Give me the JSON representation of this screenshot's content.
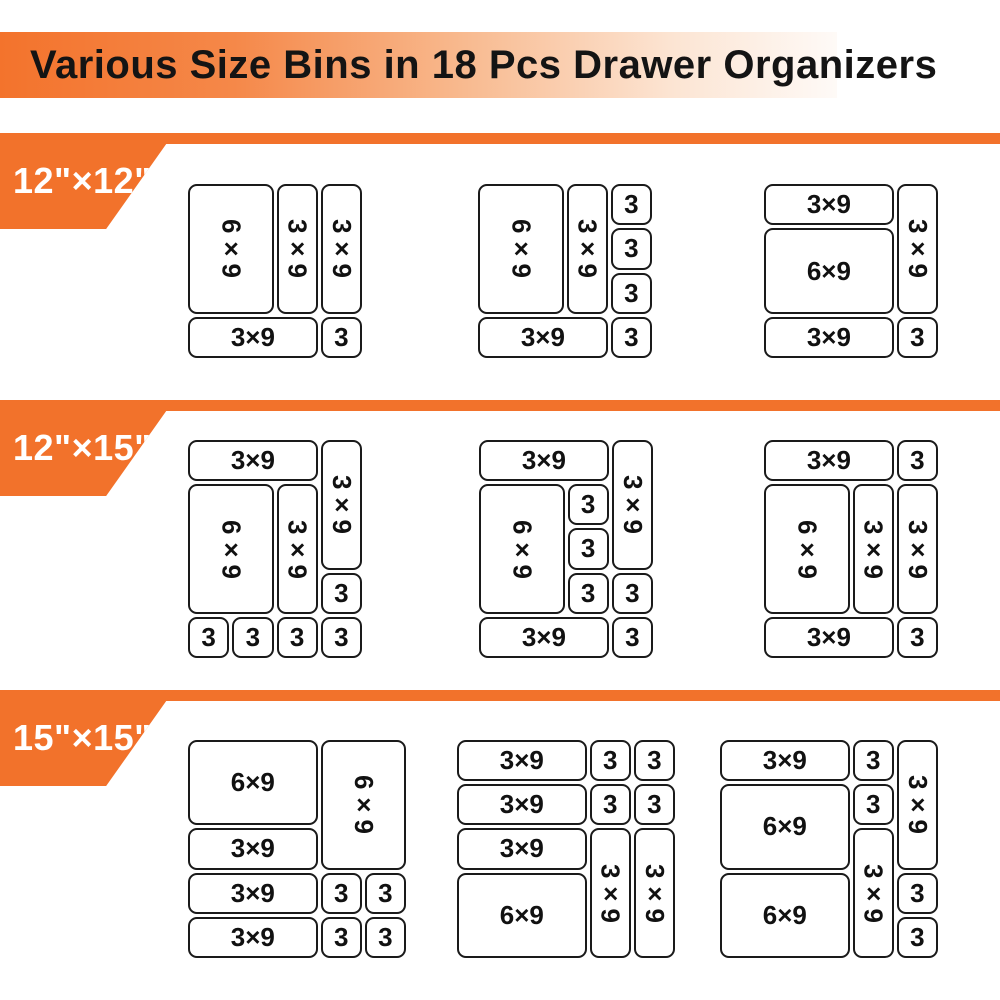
{
  "title": "Various Size Bins in 18 Pcs Drawer Organizers",
  "colors": {
    "accent_orange": "#f2722b",
    "banner_gradient_start": "#f3732c",
    "banner_gradient_end": "#fefaf7",
    "band_label_text": "#ffffff",
    "title_text": "#141414",
    "bin_border": "#1a1a1a",
    "bin_fill": "#ffffff"
  },
  "sections": [
    {
      "label": "12\"×12\"",
      "organizers": [
        {
          "cols": 4,
          "rows": 4,
          "bins": [
            {
              "label": "6×9",
              "c": 1,
              "r": 1,
              "cs": 2,
              "rs": 3,
              "vertical": true
            },
            {
              "label": "3×9",
              "c": 3,
              "r": 1,
              "cs": 1,
              "rs": 3,
              "vertical": true
            },
            {
              "label": "3×9",
              "c": 4,
              "r": 1,
              "cs": 1,
              "rs": 3,
              "vertical": true
            },
            {
              "label": "3×9",
              "c": 1,
              "r": 4,
              "cs": 3,
              "rs": 1
            },
            {
              "label": "3",
              "c": 4,
              "r": 4,
              "cs": 1,
              "rs": 1
            }
          ]
        },
        {
          "cols": 4,
          "rows": 4,
          "bins": [
            {
              "label": "6×9",
              "c": 1,
              "r": 1,
              "cs": 2,
              "rs": 3,
              "vertical": true
            },
            {
              "label": "3×9",
              "c": 3,
              "r": 1,
              "cs": 1,
              "rs": 3,
              "vertical": true
            },
            {
              "label": "3",
              "c": 4,
              "r": 1,
              "cs": 1,
              "rs": 1
            },
            {
              "label": "3",
              "c": 4,
              "r": 2,
              "cs": 1,
              "rs": 1
            },
            {
              "label": "3",
              "c": 4,
              "r": 3,
              "cs": 1,
              "rs": 1
            },
            {
              "label": "3×9",
              "c": 1,
              "r": 4,
              "cs": 3,
              "rs": 1
            },
            {
              "label": "3",
              "c": 4,
              "r": 4,
              "cs": 1,
              "rs": 1
            }
          ]
        },
        {
          "cols": 4,
          "rows": 4,
          "bins": [
            {
              "label": "3×9",
              "c": 1,
              "r": 1,
              "cs": 3,
              "rs": 1
            },
            {
              "label": "3×9",
              "c": 4,
              "r": 1,
              "cs": 1,
              "rs": 3,
              "vertical": true
            },
            {
              "label": "6×9",
              "c": 1,
              "r": 2,
              "cs": 3,
              "rs": 2
            },
            {
              "label": "3×9",
              "c": 1,
              "r": 4,
              "cs": 3,
              "rs": 1
            },
            {
              "label": "3",
              "c": 4,
              "r": 4,
              "cs": 1,
              "rs": 1
            }
          ]
        }
      ]
    },
    {
      "label": "12\"×15\"",
      "organizers": [
        {
          "cols": 4,
          "rows": 5,
          "bins": [
            {
              "label": "3×9",
              "c": 1,
              "r": 1,
              "cs": 3,
              "rs": 1
            },
            {
              "label": "3×9",
              "c": 4,
              "r": 1,
              "cs": 1,
              "rs": 3,
              "vertical": true
            },
            {
              "label": "6×9",
              "c": 1,
              "r": 2,
              "cs": 2,
              "rs": 3,
              "vertical": true
            },
            {
              "label": "3×9",
              "c": 3,
              "r": 2,
              "cs": 1,
              "rs": 3,
              "vertical": true
            },
            {
              "label": "3",
              "c": 4,
              "r": 4,
              "cs": 1,
              "rs": 1
            },
            {
              "label": "3",
              "c": 1,
              "r": 5,
              "cs": 1,
              "rs": 1
            },
            {
              "label": "3",
              "c": 2,
              "r": 5,
              "cs": 1,
              "rs": 1
            },
            {
              "label": "3",
              "c": 3,
              "r": 5,
              "cs": 1,
              "rs": 1
            },
            {
              "label": "3",
              "c": 4,
              "r": 5,
              "cs": 1,
              "rs": 1
            }
          ]
        },
        {
          "cols": 4,
          "rows": 5,
          "bins": [
            {
              "label": "3×9",
              "c": 1,
              "r": 1,
              "cs": 3,
              "rs": 1
            },
            {
              "label": "3×9",
              "c": 4,
              "r": 1,
              "cs": 1,
              "rs": 3,
              "vertical": true
            },
            {
              "label": "6×9",
              "c": 1,
              "r": 2,
              "cs": 2,
              "rs": 3,
              "vertical": true
            },
            {
              "label": "3",
              "c": 3,
              "r": 2,
              "cs": 1,
              "rs": 1
            },
            {
              "label": "3",
              "c": 3,
              "r": 3,
              "cs": 1,
              "rs": 1
            },
            {
              "label": "3",
              "c": 3,
              "r": 4,
              "cs": 1,
              "rs": 1
            },
            {
              "label": "3",
              "c": 4,
              "r": 4,
              "cs": 1,
              "rs": 1
            },
            {
              "label": "3×9",
              "c": 1,
              "r": 5,
              "cs": 3,
              "rs": 1
            },
            {
              "label": "3",
              "c": 4,
              "r": 5,
              "cs": 1,
              "rs": 1
            }
          ]
        },
        {
          "cols": 4,
          "rows": 5,
          "bins": [
            {
              "label": "3×9",
              "c": 1,
              "r": 1,
              "cs": 3,
              "rs": 1
            },
            {
              "label": "3",
              "c": 4,
              "r": 1,
              "cs": 1,
              "rs": 1
            },
            {
              "label": "6×9",
              "c": 1,
              "r": 2,
              "cs": 2,
              "rs": 3,
              "vertical": true
            },
            {
              "label": "3×9",
              "c": 3,
              "r": 2,
              "cs": 1,
              "rs": 3,
              "vertical": true
            },
            {
              "label": "3×9",
              "c": 4,
              "r": 2,
              "cs": 1,
              "rs": 3,
              "vertical": true
            },
            {
              "label": "3×9",
              "c": 1,
              "r": 5,
              "cs": 3,
              "rs": 1
            },
            {
              "label": "3",
              "c": 4,
              "r": 5,
              "cs": 1,
              "rs": 1
            }
          ]
        }
      ]
    },
    {
      "label": "15\"×15\"",
      "organizers": [
        {
          "cols": 5,
          "rows": 5,
          "bins": [
            {
              "label": "6×9",
              "c": 1,
              "r": 1,
              "cs": 3,
              "rs": 2
            },
            {
              "label": "6×9",
              "c": 4,
              "r": 1,
              "cs": 2,
              "rs": 3,
              "vertical": true
            },
            {
              "label": "3×9",
              "c": 1,
              "r": 3,
              "cs": 3,
              "rs": 1
            },
            {
              "label": "3×9",
              "c": 1,
              "r": 4,
              "cs": 3,
              "rs": 1
            },
            {
              "label": "3",
              "c": 4,
              "r": 4,
              "cs": 1,
              "rs": 1
            },
            {
              "label": "3",
              "c": 5,
              "r": 4,
              "cs": 1,
              "rs": 1
            },
            {
              "label": "3×9",
              "c": 1,
              "r": 5,
              "cs": 3,
              "rs": 1
            },
            {
              "label": "3",
              "c": 4,
              "r": 5,
              "cs": 1,
              "rs": 1
            },
            {
              "label": "3",
              "c": 5,
              "r": 5,
              "cs": 1,
              "rs": 1
            }
          ]
        },
        {
          "cols": 5,
          "rows": 5,
          "bins": [
            {
              "label": "3×9",
              "c": 1,
              "r": 1,
              "cs": 3,
              "rs": 1
            },
            {
              "label": "3",
              "c": 4,
              "r": 1,
              "cs": 1,
              "rs": 1
            },
            {
              "label": "3",
              "c": 5,
              "r": 1,
              "cs": 1,
              "rs": 1
            },
            {
              "label": "3×9",
              "c": 1,
              "r": 2,
              "cs": 3,
              "rs": 1
            },
            {
              "label": "3",
              "c": 4,
              "r": 2,
              "cs": 1,
              "rs": 1
            },
            {
              "label": "3",
              "c": 5,
              "r": 2,
              "cs": 1,
              "rs": 1
            },
            {
              "label": "3×9",
              "c": 1,
              "r": 3,
              "cs": 3,
              "rs": 1
            },
            {
              "label": "6×9",
              "c": 1,
              "r": 4,
              "cs": 3,
              "rs": 2
            },
            {
              "label": "3×9",
              "c": 4,
              "r": 3,
              "cs": 1,
              "rs": 3,
              "vertical": true
            },
            {
              "label": "3×9",
              "c": 5,
              "r": 3,
              "cs": 1,
              "rs": 3,
              "vertical": true
            }
          ]
        },
        {
          "cols": 5,
          "rows": 5,
          "bins": [
            {
              "label": "3×9",
              "c": 1,
              "r": 1,
              "cs": 3,
              "rs": 1
            },
            {
              "label": "3",
              "c": 4,
              "r": 1,
              "cs": 1,
              "rs": 1
            },
            {
              "label": "3×9",
              "c": 5,
              "r": 1,
              "cs": 1,
              "rs": 3,
              "vertical": true
            },
            {
              "label": "6×9",
              "c": 1,
              "r": 2,
              "cs": 3,
              "rs": 2
            },
            {
              "label": "3",
              "c": 4,
              "r": 2,
              "cs": 1,
              "rs": 1
            },
            {
              "label": "3×9",
              "c": 4,
              "r": 3,
              "cs": 1,
              "rs": 3,
              "vertical": true
            },
            {
              "label": "6×9",
              "c": 1,
              "r": 4,
              "cs": 3,
              "rs": 2
            },
            {
              "label": "3",
              "c": 5,
              "r": 4,
              "cs": 1,
              "rs": 1
            },
            {
              "label": "3",
              "c": 5,
              "r": 5,
              "cs": 1,
              "rs": 1
            }
          ]
        }
      ]
    }
  ]
}
